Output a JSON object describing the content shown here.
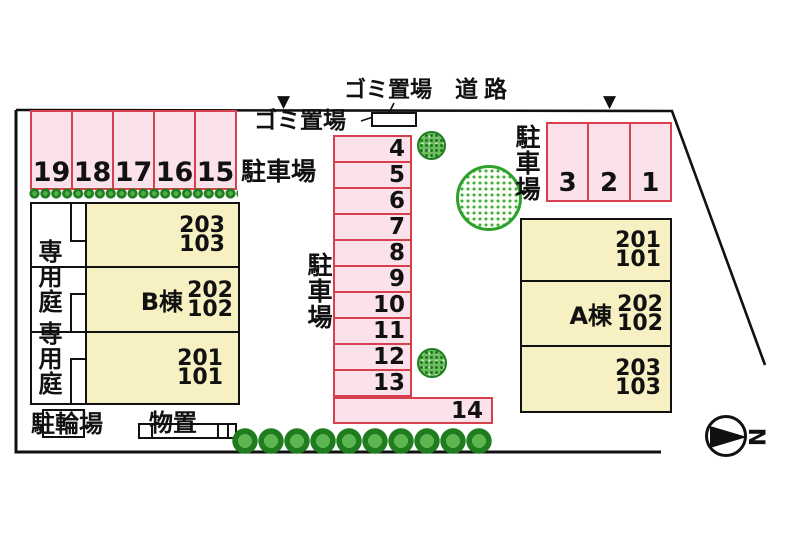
{
  "site": {
    "road_label": "道路",
    "garbage_top_label": "ゴミ置場",
    "garbage_side_label": "ゴミ置場",
    "benchmark_left": "▼",
    "benchmark_right": "▼"
  },
  "parking_left": {
    "area_label": "駐車場",
    "spaces": [
      "19",
      "18",
      "17",
      "16",
      "15"
    ]
  },
  "parking_center": {
    "area_label": "駐車場",
    "rows": [
      "4",
      "5",
      "6",
      "7",
      "8",
      "9",
      "10",
      "11",
      "12",
      "13"
    ],
    "wide_space": "14"
  },
  "parking_right": {
    "area_label": "駐車場",
    "spaces": [
      "3",
      "2",
      "1"
    ]
  },
  "building_b": {
    "name": "B棟",
    "sections": [
      {
        "upper": "203",
        "lower": "103"
      },
      {
        "upper": "202",
        "lower": "102"
      },
      {
        "upper": "201",
        "lower": "101"
      }
    ]
  },
  "building_a": {
    "name": "A棟",
    "sections": [
      {
        "upper": "201",
        "lower": "101"
      },
      {
        "upper": "202",
        "lower": "102"
      },
      {
        "upper": "203",
        "lower": "103"
      }
    ]
  },
  "garden": {
    "label_top": "専用庭",
    "label_bottom": "専用庭"
  },
  "bicycle_parking": {
    "label": "駐輪場"
  },
  "storage": {
    "label": "物置"
  },
  "compass": {
    "north_letter": "N"
  },
  "colors": {
    "parking_fill": "#fbe2ea",
    "parking_border": "#d9404e",
    "building_fill": "#f7f0c2",
    "outline": "#111111",
    "tree_green": "#2ca12c"
  }
}
